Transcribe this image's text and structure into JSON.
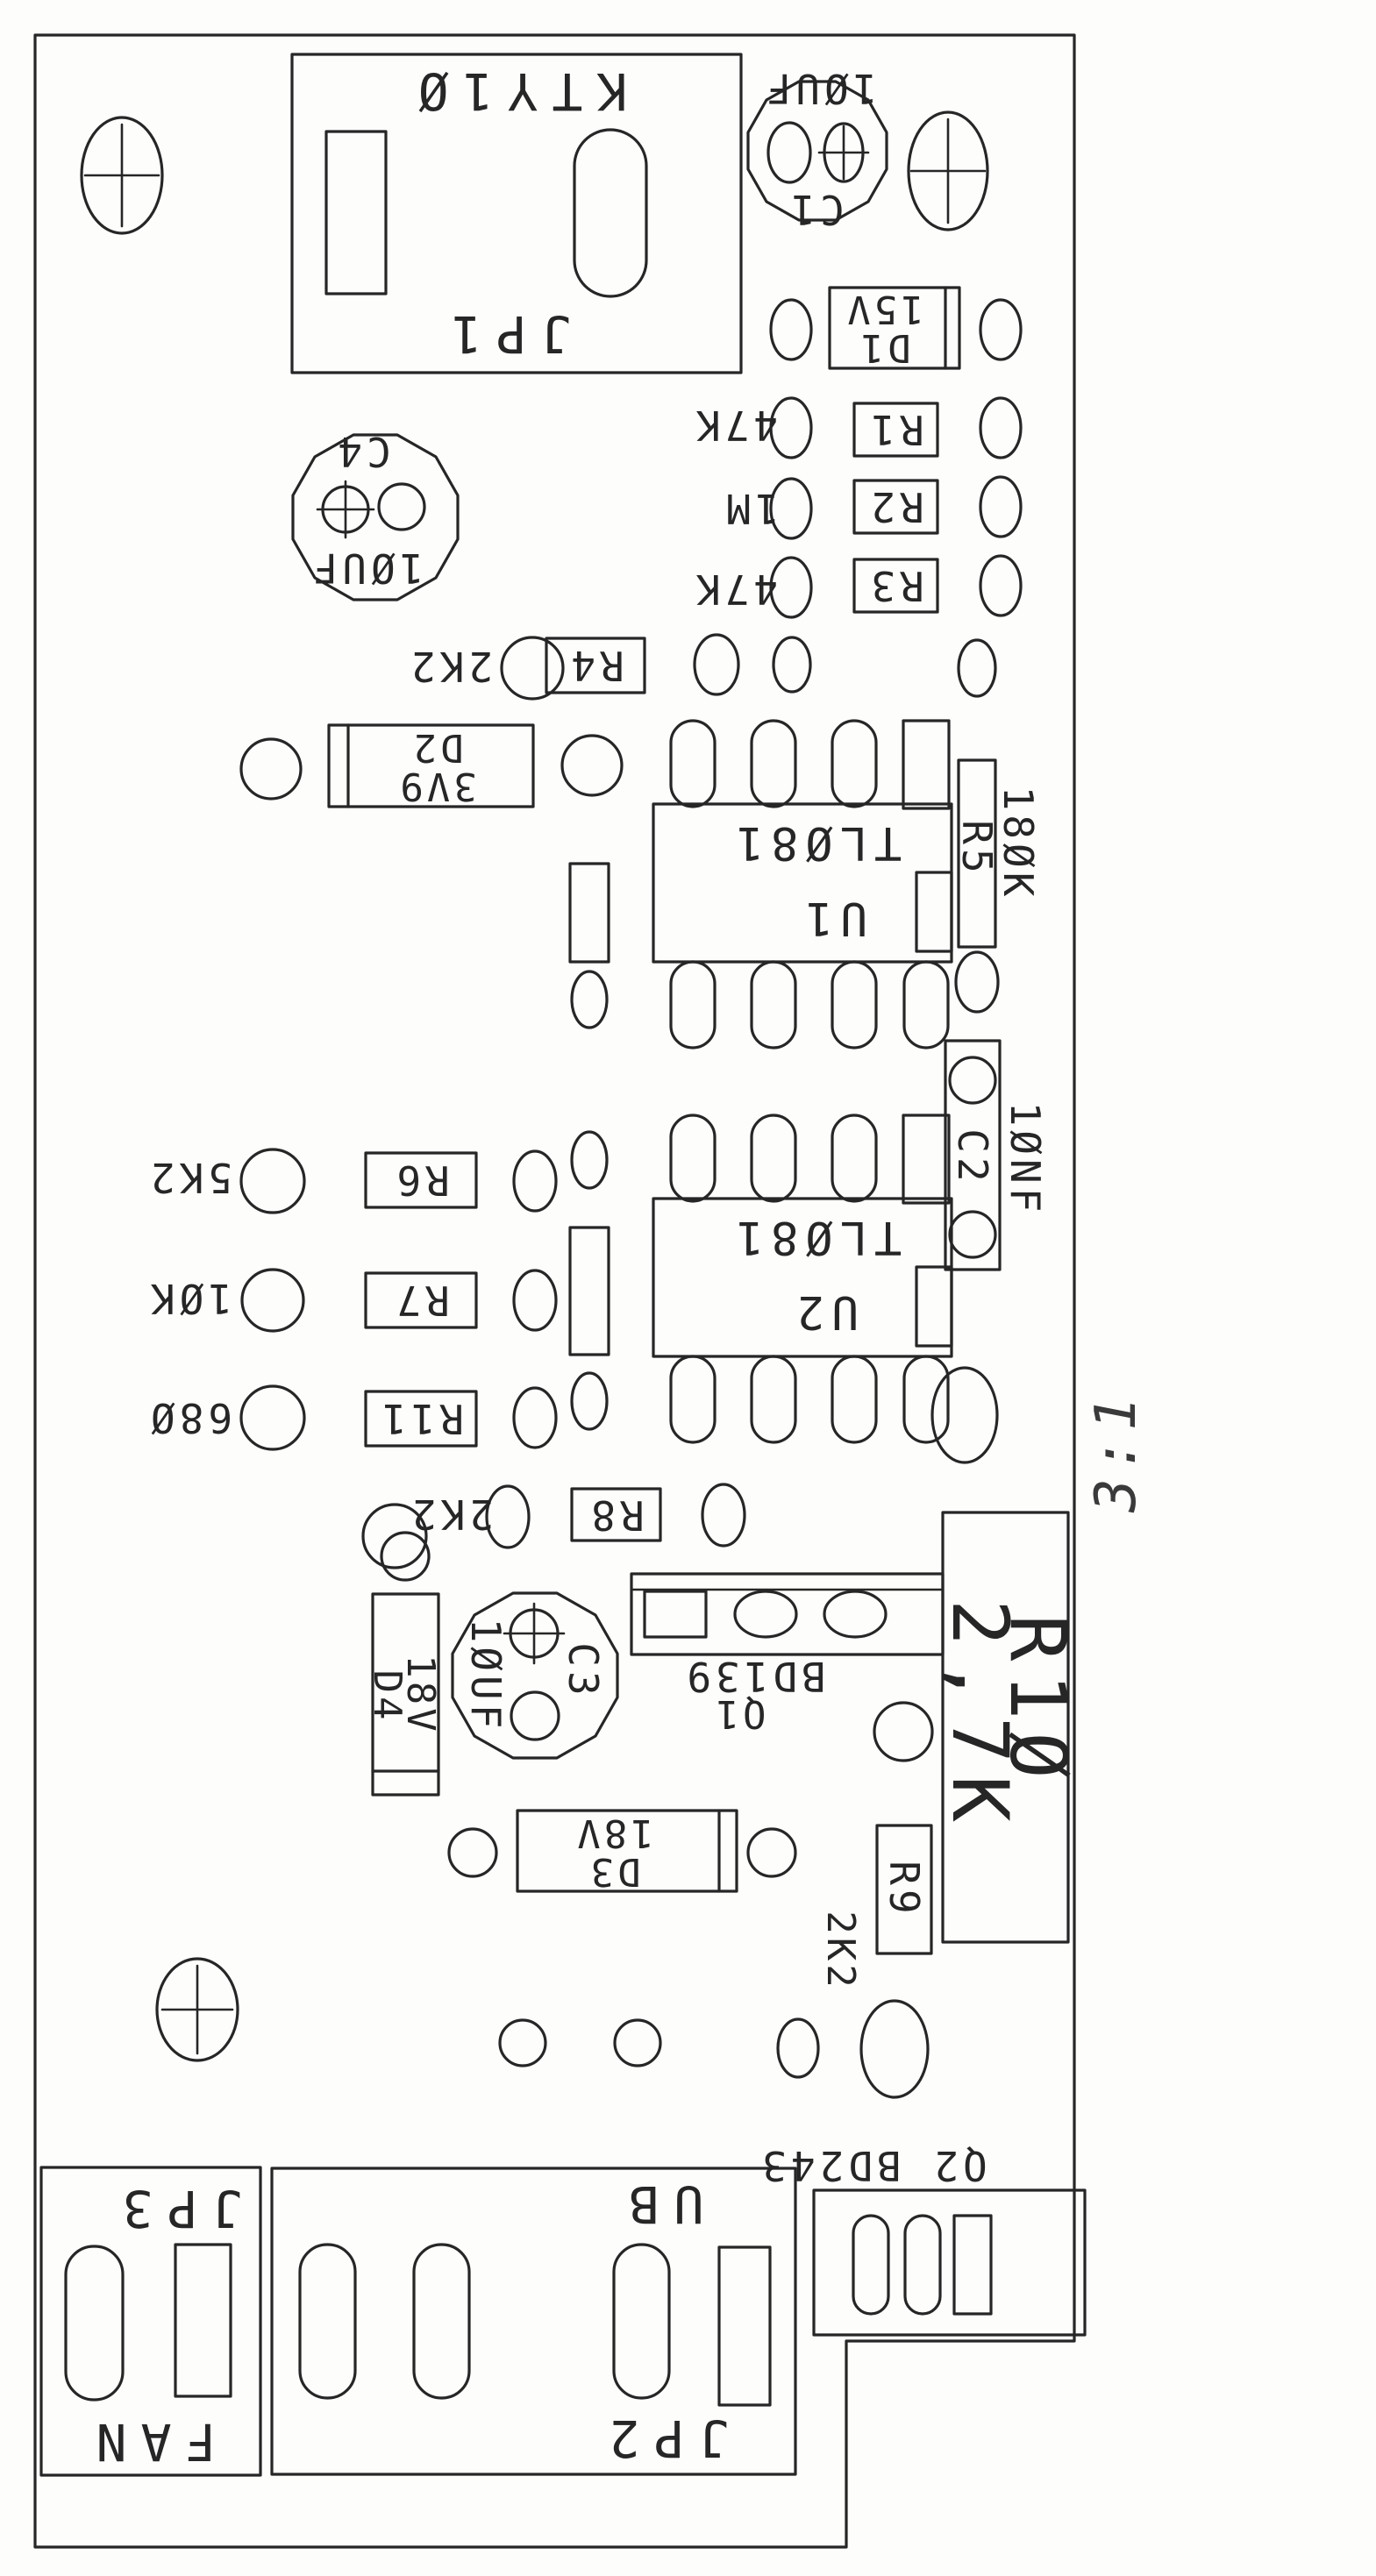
{
  "drawing": {
    "kind": "pcb-component-placement-drawing",
    "scale_annotation": "3:1"
  },
  "colors": {
    "line": "#262626",
    "background": "#fdfdfc"
  },
  "components": {
    "jp1": {
      "name": "JP1",
      "part": "KTY1Ø"
    },
    "c1": {
      "name": "C1",
      "value": "1ØUF"
    },
    "c4": {
      "name": "C4",
      "value": "1ØUF"
    },
    "d1": {
      "name": "D1",
      "value": "15V"
    },
    "r1": {
      "name": "R1",
      "value": "47K"
    },
    "r2": {
      "name": "R2",
      "value": "1M"
    },
    "r3": {
      "name": "R3",
      "value": "47K"
    },
    "r4": {
      "name": "R4",
      "value": "2K2"
    },
    "d2": {
      "name": "D2",
      "value": "3V9"
    },
    "u1": {
      "name": "U1",
      "part": "TLØ81"
    },
    "r5": {
      "name": "R5",
      "value": "18ØK"
    },
    "c2": {
      "name": "C2",
      "value": "1ØNF"
    },
    "u2": {
      "name": "U2",
      "part": "TLØ81"
    },
    "r6": {
      "name": "R6",
      "value": "5K2"
    },
    "r7": {
      "name": "R7",
      "value": "1ØK"
    },
    "r11": {
      "name": "R11",
      "value": "68Ø"
    },
    "r8": {
      "name": "R8",
      "value": "2K2"
    },
    "c3": {
      "name": "C3",
      "value": "1ØUF"
    },
    "d4": {
      "name": "D4",
      "value": "18V"
    },
    "q1": {
      "name": "Q1",
      "part": "BD139"
    },
    "d3": {
      "name": "D3",
      "value": "18V"
    },
    "r9": {
      "name": "R9",
      "value": "2K2"
    },
    "r10": {
      "name": "R1Ø",
      "value": "2,7K"
    },
    "q2": {
      "name": "Q2",
      "part": "BD243",
      "label": "Q2 BD243"
    },
    "jp2": {
      "name": "JP2",
      "label": "UB"
    },
    "jp3": {
      "name": "JP3",
      "label": "FAN"
    }
  }
}
